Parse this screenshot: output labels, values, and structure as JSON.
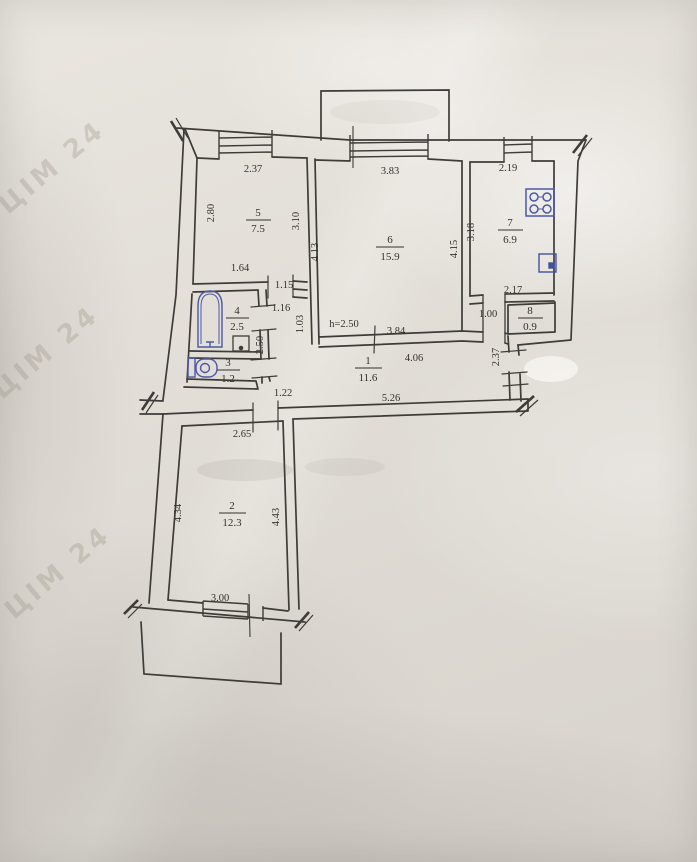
{
  "rooms": {
    "r1": {
      "num": "1",
      "area": "11.6"
    },
    "r2": {
      "num": "2",
      "area": "12.3"
    },
    "r3": {
      "num": "3",
      "area": "1.2"
    },
    "r4": {
      "num": "4",
      "area": "2.5"
    },
    "r5": {
      "num": "5",
      "area": "7.5"
    },
    "r6": {
      "num": "6",
      "area": "15.9"
    },
    "r7": {
      "num": "7",
      "area": "6.9"
    },
    "r8": {
      "num": "8",
      "area": "0.9"
    }
  },
  "dims": {
    "w5_top": "2.37",
    "w6_top": "3.83",
    "w7_top": "2.19",
    "w5_left": "2.80",
    "w5_right": "3.10",
    "w6_left": "4.13",
    "w6_right": "4.15",
    "w7_left": "3.18",
    "w4_top": "1.64",
    "door_room5": "1.15",
    "door_bath_passage": "1.16",
    "passage_width": "1.03",
    "passage_height": "2.50",
    "ceiling_height": "h=2.50",
    "w6_bottom": "3.84",
    "w7_bottom": "2.17",
    "door_kitchen": "1.00",
    "hall_top": "4.06",
    "entry_wall": "2.37",
    "door_room2": "1.22",
    "hall_bottom": "5.26",
    "w2_top": "2.65",
    "w2_left": "4.34",
    "w2_right": "4.43",
    "w2_bottom": "3.00"
  },
  "watermark": "ЦІМ 24"
}
